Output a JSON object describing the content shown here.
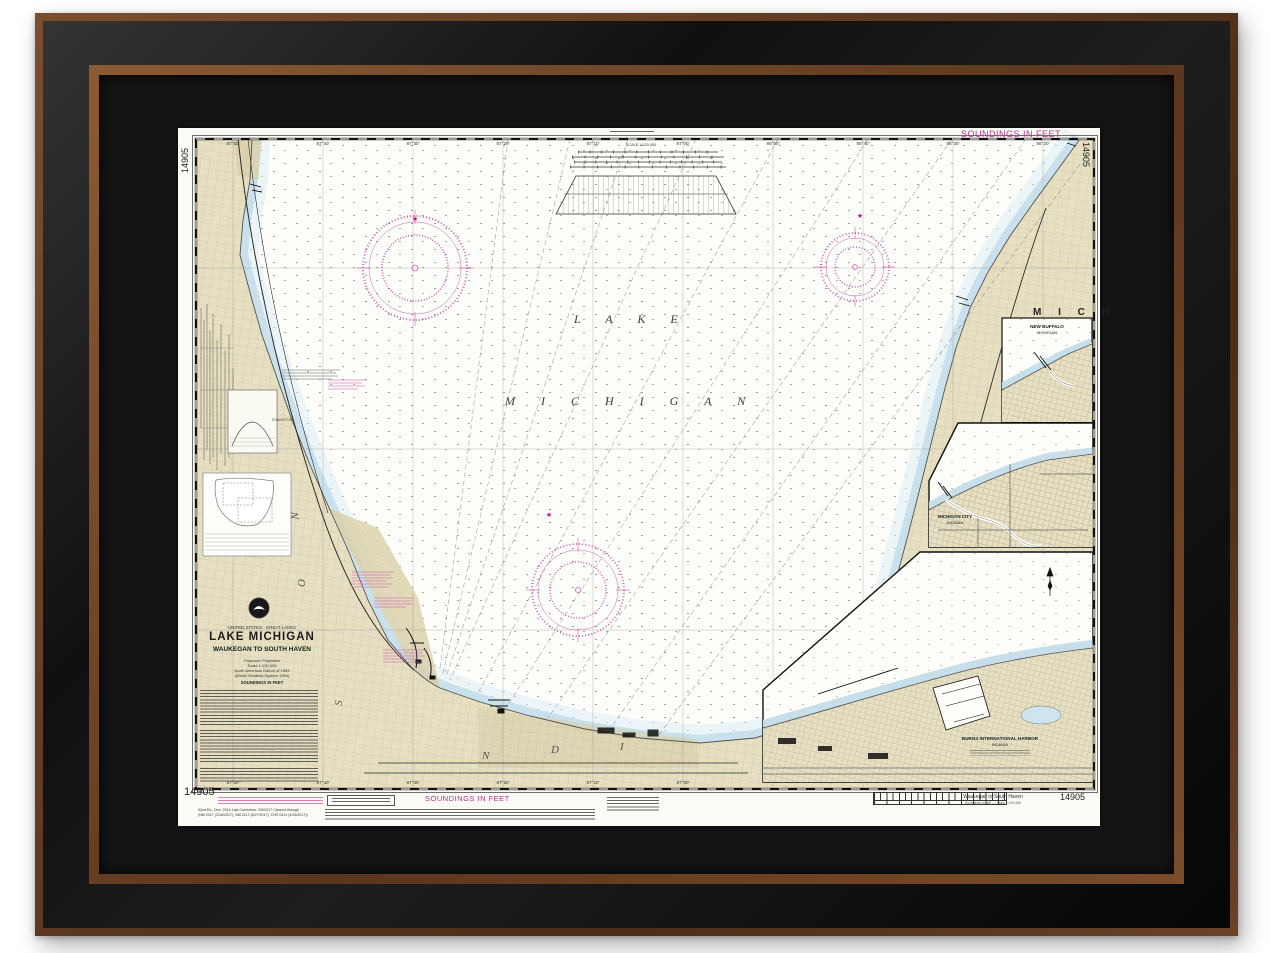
{
  "chart": {
    "number": "14905",
    "soundings_feet": "SOUNDINGS IN FEET",
    "scale_label": "SCALE 1:120,000",
    "title_block": {
      "region": "UNITED STATES - GREAT LAKES",
      "title": "LAKE MICHIGAN",
      "subtitle": "WAUKEGAN TO SOUTH HAVEN",
      "projection": "Polyconic Projection",
      "scale": "Scale 1:120,000",
      "datum": "North American Datum of 1983",
      "datum2": "(World Geodetic System 1984)",
      "soundings": "SOUNDINGS IN FEET"
    },
    "lake_label": {
      "line1": "L A K E",
      "line2": "M I C H I G A N"
    },
    "state_labels": {
      "east": "M I C H",
      "west_letters": [
        "N",
        "O",
        "S"
      ],
      "south_letters": [
        "N",
        "D",
        "I"
      ]
    },
    "city_labels": {
      "evanston": "EVANSTON"
    },
    "insets": {
      "new_buffalo": {
        "line1": "NEW BUFFALO",
        "line2": "MICHIGAN"
      },
      "michigan_city": {
        "line1": "MICHIGAN CITY",
        "line2": "INDIANA"
      },
      "burns_harbor": {
        "line1": "BURNS INTERNATIONAL HARBOR",
        "line2": "INDIANA"
      }
    },
    "bottom": {
      "edition_line1": "32nd Ed., Dec. 2016   Last Correction: 2/8/2017   Cleared through",
      "edition_line2": "(NM 2017 (2/16/2017), NM 2117 (5/27/2017), CHS 0411 (4/28/2017))",
      "soundings": "SOUNDINGS IN FEET",
      "panel_title": "Waukegan to South Haven",
      "panel_subtitle": "Soundings in feet — Scale 1:120,000"
    },
    "lon_labels": [
      "87°50'",
      "87°40'",
      "87°30'",
      "87°20'",
      "87°10'",
      "87°00'",
      "86°50'",
      "86°40'",
      "86°30'",
      "86°20'"
    ],
    "colors": {
      "magenta": "#bd2c92",
      "land": "#e7dfc2",
      "shallow": "#c6dfeb",
      "mat": "#141414",
      "frame_brown": "#6b4226"
    }
  }
}
